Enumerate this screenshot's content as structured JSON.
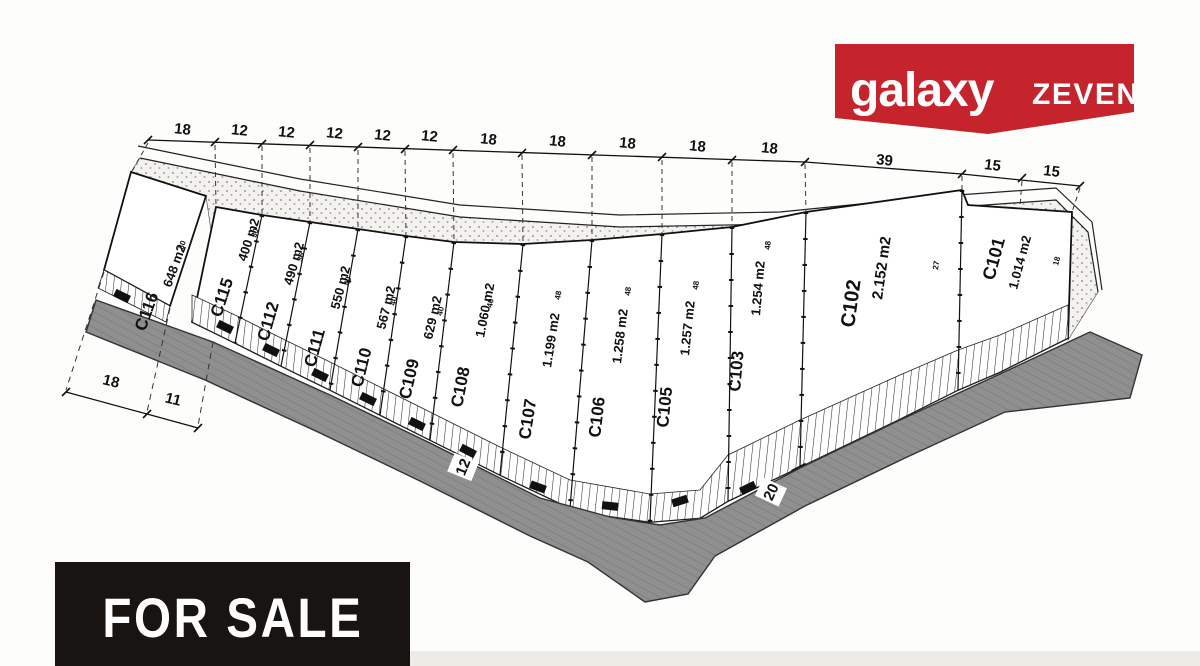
{
  "logo": {
    "primary": "galaxy",
    "secondary": "ZEVEN"
  },
  "banner": {
    "label": "FOR SALE"
  },
  "colors": {
    "banner_red": "#c5242c",
    "road_gray": "#8f8f8f",
    "sale_black": "#171412"
  },
  "top_dims": [
    "18",
    "12",
    "12",
    "12",
    "12",
    "12",
    "18",
    "18",
    "18",
    "18",
    "18",
    "39",
    "15",
    "15"
  ],
  "left_dims": [
    "18",
    "11"
  ],
  "road_labels": [
    "12",
    "20"
  ],
  "plots": [
    {
      "id": "C116",
      "area": "648 m2",
      "depth": "30"
    },
    {
      "id": "C115",
      "area": "400 m2",
      "depth": "30"
    },
    {
      "id": "C112",
      "area": "490 m2",
      "depth": "36"
    },
    {
      "id": "C111",
      "area": "550 m2",
      "depth": "40"
    },
    {
      "id": "C110",
      "area": "567 m2",
      "depth": "40"
    },
    {
      "id": "C109",
      "area": "629 m2",
      "depth": "40"
    },
    {
      "id": "C108",
      "area": "1.060 m2",
      "depth": "40"
    },
    {
      "id": "C107",
      "area": "1.199 m2",
      "depth": "48"
    },
    {
      "id": "C106",
      "area": "1.258 m2",
      "depth": "48"
    },
    {
      "id": "C105",
      "area": "1.257 m2",
      "depth": "48"
    },
    {
      "id": "C103",
      "area": "1.254 m2",
      "depth": "48"
    },
    {
      "id": "C102",
      "area": "2.152 m2",
      "depth": "27"
    },
    {
      "id": "C101",
      "area": "1.014 m2",
      "depth": "18"
    }
  ]
}
